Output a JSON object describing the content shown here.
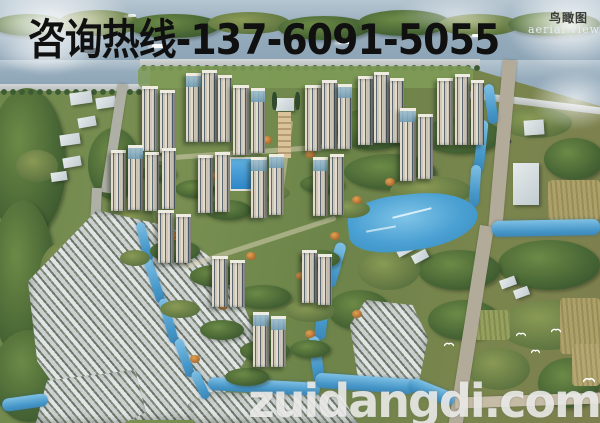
{
  "overlay": {
    "hotline": "咨询热线-137-6091-5055",
    "corner_label_cn": "鸟瞰图",
    "corner_label_en": "aerial view",
    "watermark": "zuidangdi.com"
  },
  "colors": {
    "hotline_text": "#101010",
    "watermark_text": "#f7f7f4",
    "corner_label_cn_text": "#3a3d39",
    "corner_label_en_text": "#e4ecf2",
    "sky_water": "#97adbd",
    "river": "#4596c8",
    "foliage_dark": "#3e5c30",
    "foliage_light": "#7a9053",
    "autumn_accent": "#c07a3a",
    "tower_facade": "#d8d2c5",
    "tower_glass_crown": "#7fa6ba",
    "village_roof": "#d4d8d9",
    "road": "#aeafa5"
  }
}
